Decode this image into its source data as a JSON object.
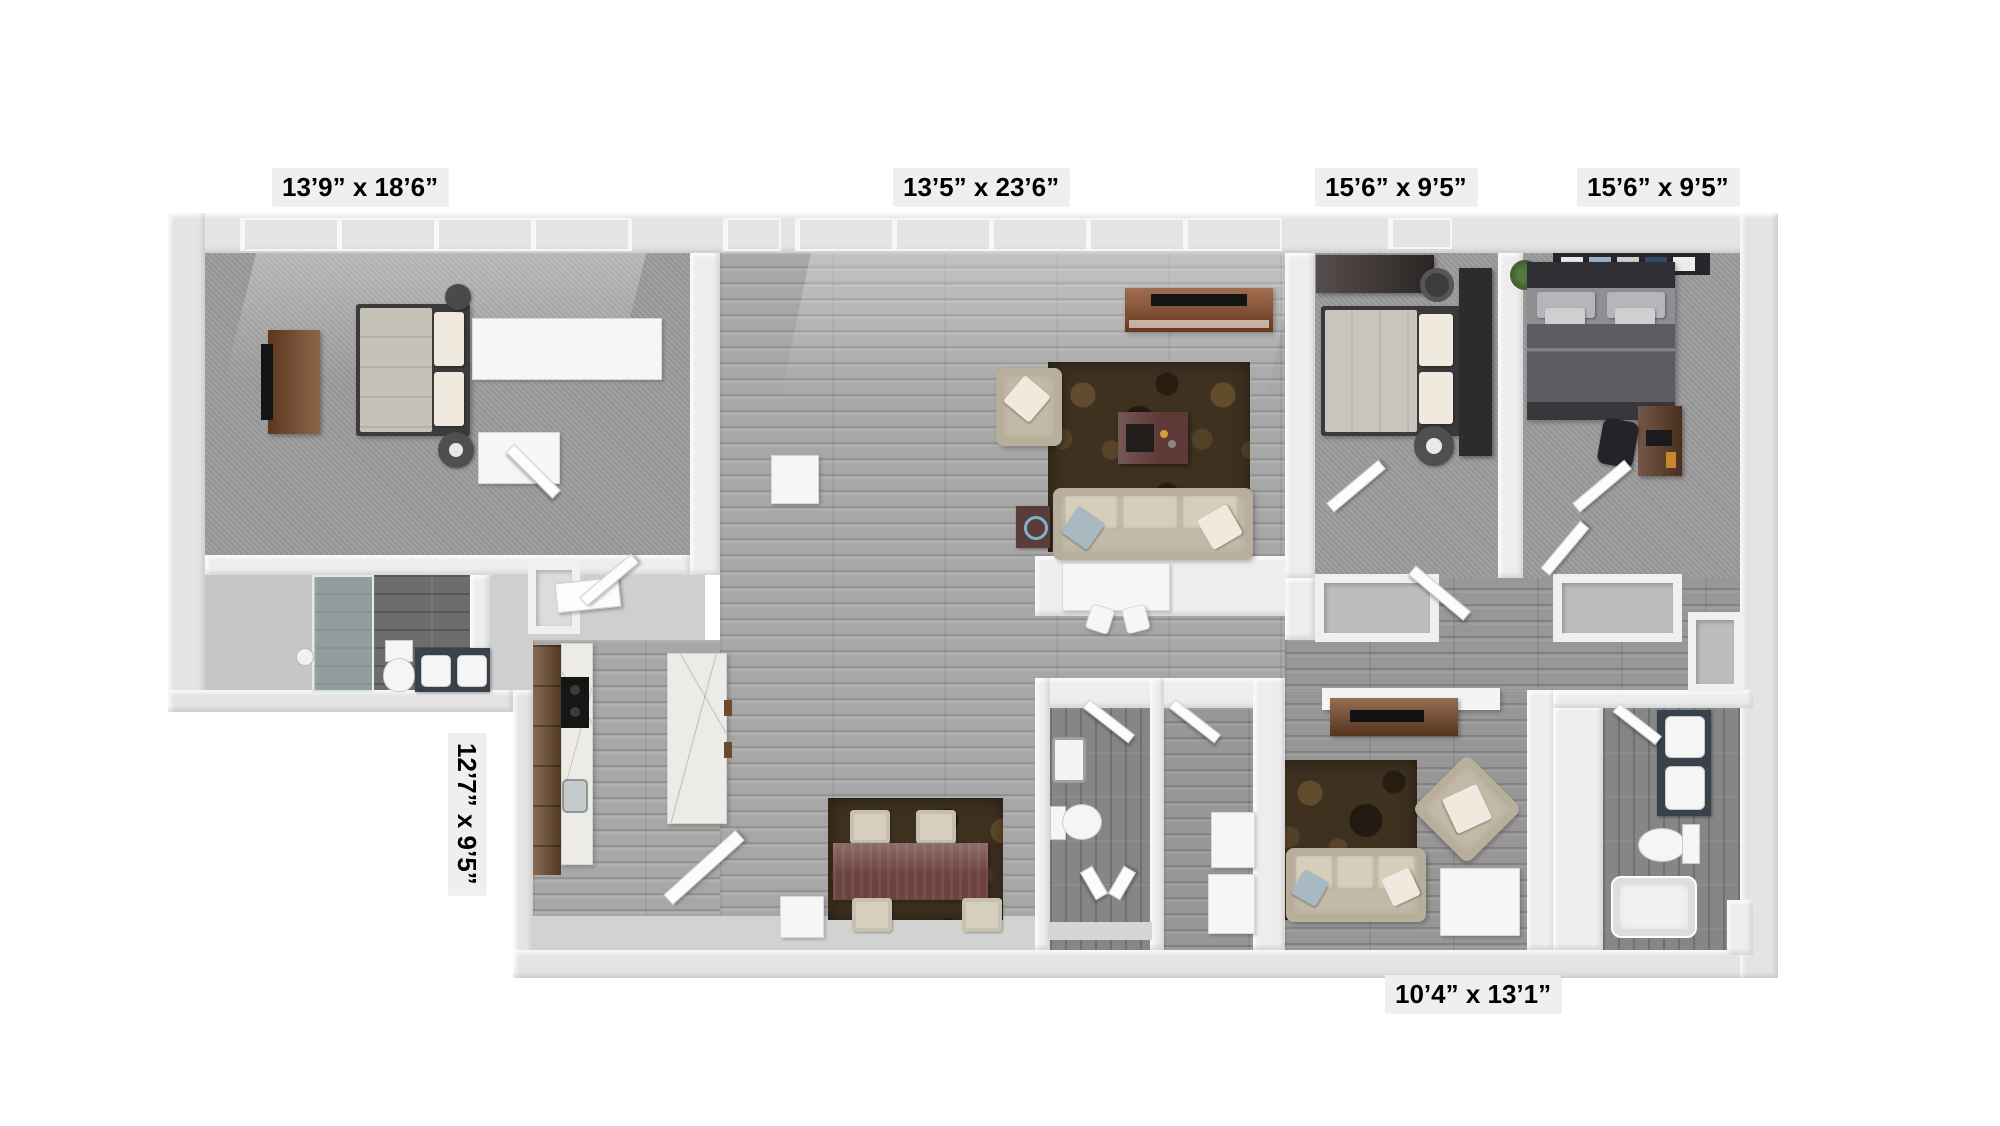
{
  "labels": {
    "master_bedroom": "13’9” x 18’6”",
    "living_room": "13’5” x 23’6”",
    "bedroom_middle": "15’6” x 9’5”",
    "bedroom_right": "15’6” x 9’5”",
    "kitchen": "12’7” x 9’5”",
    "den": "10’4” x 13’1”"
  },
  "colors": {
    "background": "#ffffff",
    "wall": "#e4e4e4",
    "carpet": "#9c9c9c",
    "wood_floor": "#a7a7a7",
    "bath_tile": "#6d6d6d",
    "rug_brown": "#3f3120",
    "sofa_beige": "#c2b9a7",
    "cabinet_brown": "#6b4a2e",
    "console_brown": "#8a4a26",
    "table_brown": "#6d4340",
    "marble": "#edebe6",
    "tv_black": "#141414",
    "label_background": "#efefef",
    "label_text": "#000000"
  }
}
